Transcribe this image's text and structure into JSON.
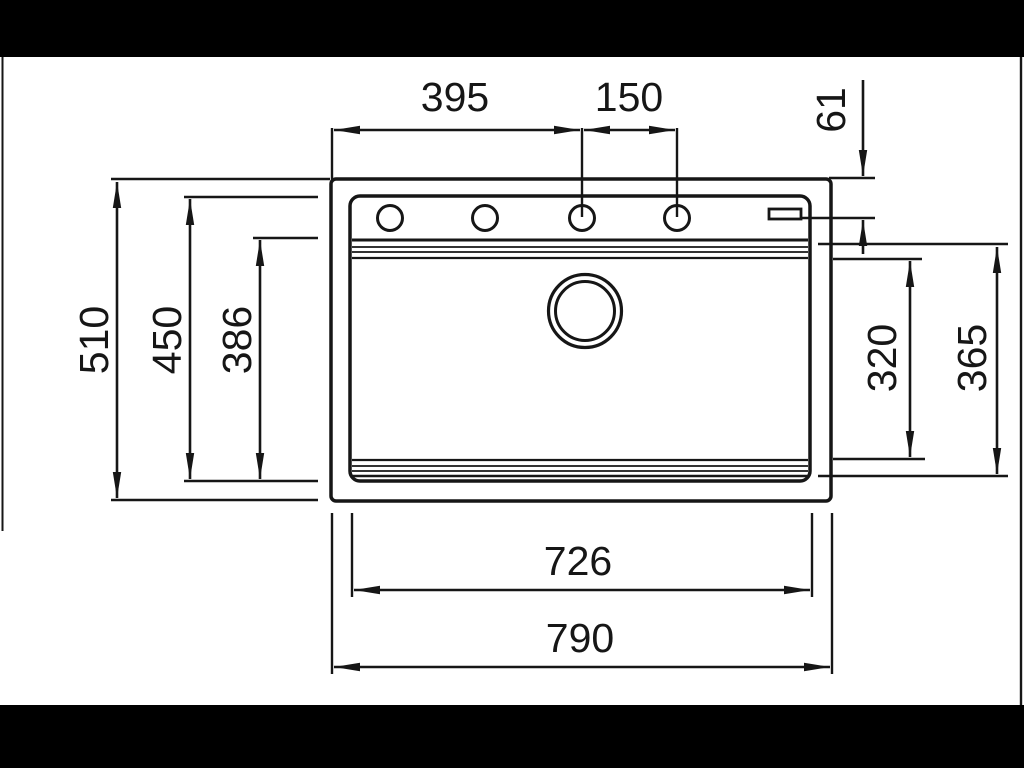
{
  "drawing": {
    "type": "technical-dimension-drawing",
    "subject": "sink-top-view",
    "dimensions": {
      "top_left_width": "395",
      "top_right_width": "150",
      "corner_offset": "61",
      "outer_height": "510",
      "rim_height": "450",
      "bowl_depth": "386",
      "bowl_height_right": "320",
      "inner_height_right": "365",
      "rim_width_bottom": "726",
      "outer_width_bottom": "790"
    },
    "colors": {
      "line": "#161616",
      "letterbox": "#000000",
      "paper": "#ffffff"
    }
  }
}
